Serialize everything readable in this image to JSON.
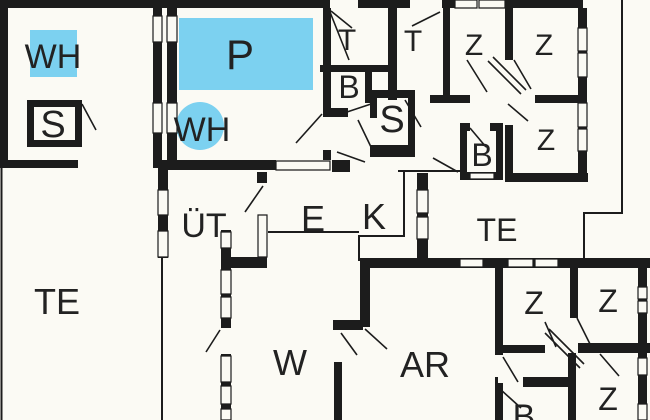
{
  "title": "Floor plan",
  "colors": {
    "background": "#fbfaf4",
    "wall": "#1c1c1c",
    "water": "#7cd1f0",
    "text": "#222222"
  },
  "rooms": {
    "wh_square": {
      "label": "WH"
    },
    "sauna_small": {
      "label": "S"
    },
    "pool": {
      "label": "P"
    },
    "wh_circle": {
      "label": "WH"
    },
    "toilet_1": {
      "label": "T"
    },
    "toilet_2": {
      "label": "T"
    },
    "bath_top": {
      "label": "B"
    },
    "sauna_main": {
      "label": "S"
    },
    "bedroom_ne_1": {
      "label": "Z"
    },
    "bedroom_ne_2": {
      "label": "Z"
    },
    "bedroom_ne_3": {
      "label": "Z"
    },
    "bath_ne": {
      "label": "B"
    },
    "terrace_right": {
      "label": "TE"
    },
    "utility": {
      "label": "ÜT"
    },
    "entry": {
      "label": "E"
    },
    "kitchen": {
      "label": "K"
    },
    "terrace_left": {
      "label": "TE"
    },
    "living": {
      "label": "W"
    },
    "work": {
      "label": "AR"
    },
    "bedroom_se_1": {
      "label": "Z"
    },
    "bedroom_se_2": {
      "label": "Z"
    },
    "bedroom_se_3": {
      "label": "Z"
    },
    "bath_se": {
      "label": "B"
    }
  }
}
